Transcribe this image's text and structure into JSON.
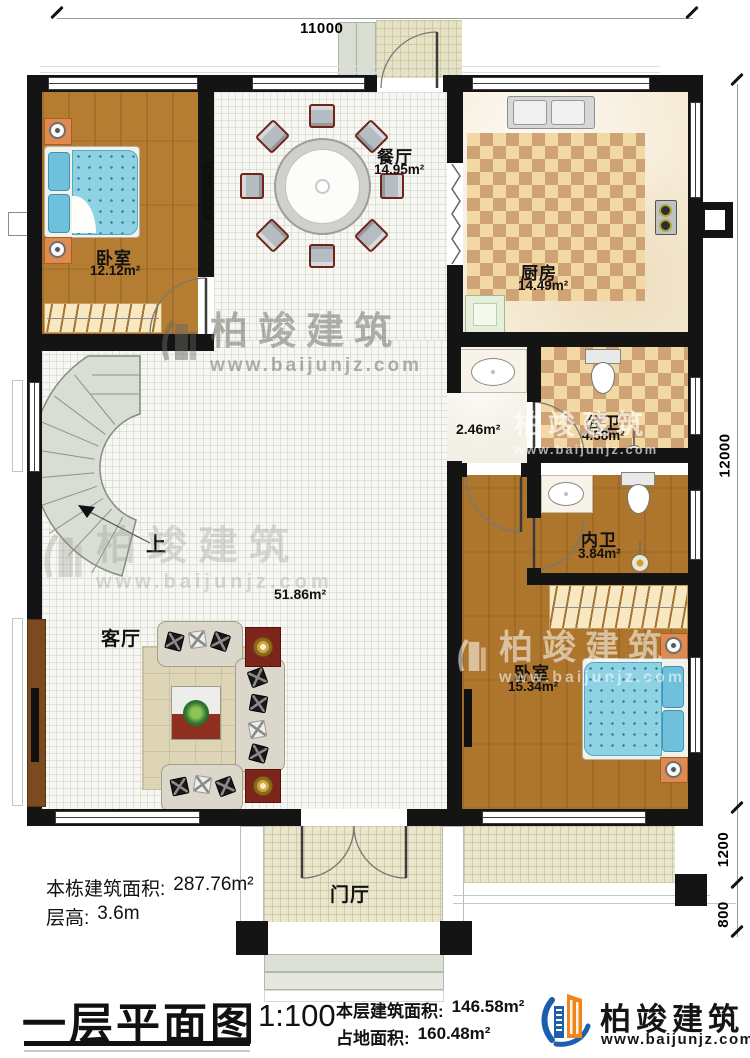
{
  "dimensions": {
    "top": "11000",
    "right_main": "12000",
    "right_porch": "1200",
    "right_steps": "800"
  },
  "rooms": [
    {
      "name": "卧室",
      "area": "12.12m²"
    },
    {
      "name": "餐厅",
      "area": "14.95m²"
    },
    {
      "name": "厨房",
      "area": "14.49m²"
    },
    {
      "name": "公卫",
      "area": "4.58m²"
    },
    {
      "name": "",
      "area": "2.46m²"
    },
    {
      "name": "内卫",
      "area": "3.84m²"
    },
    {
      "name": "卧室",
      "area": "15.34m²"
    },
    {
      "name": "客厅",
      "area": "51.86m²"
    },
    {
      "name": "门厅",
      "area": ""
    }
  ],
  "stairs": {
    "up_label": "上"
  },
  "notes": {
    "total_area_label": "本栋建筑面积:",
    "total_area_value": "287.76m²",
    "floor_height_label": "层高:",
    "floor_height_value": "3.6m"
  },
  "title_block": {
    "title": "一层平面图",
    "scale": "1:100",
    "floor_area_label": "本层建筑面积:",
    "floor_area_value": "146.58m²",
    "site_area_label": "占地面积:",
    "site_area_value": "160.48m²"
  },
  "brand": {
    "name": "柏竣建筑",
    "url": "www.baijunjz.com"
  },
  "colors": {
    "wall": "#141414",
    "wood": "#b47d31",
    "checker_light": "#f2d9a4",
    "checker_dark": "#cfa376",
    "brand_blue": "#1b5fae",
    "brand_orange": "#f08519"
  }
}
